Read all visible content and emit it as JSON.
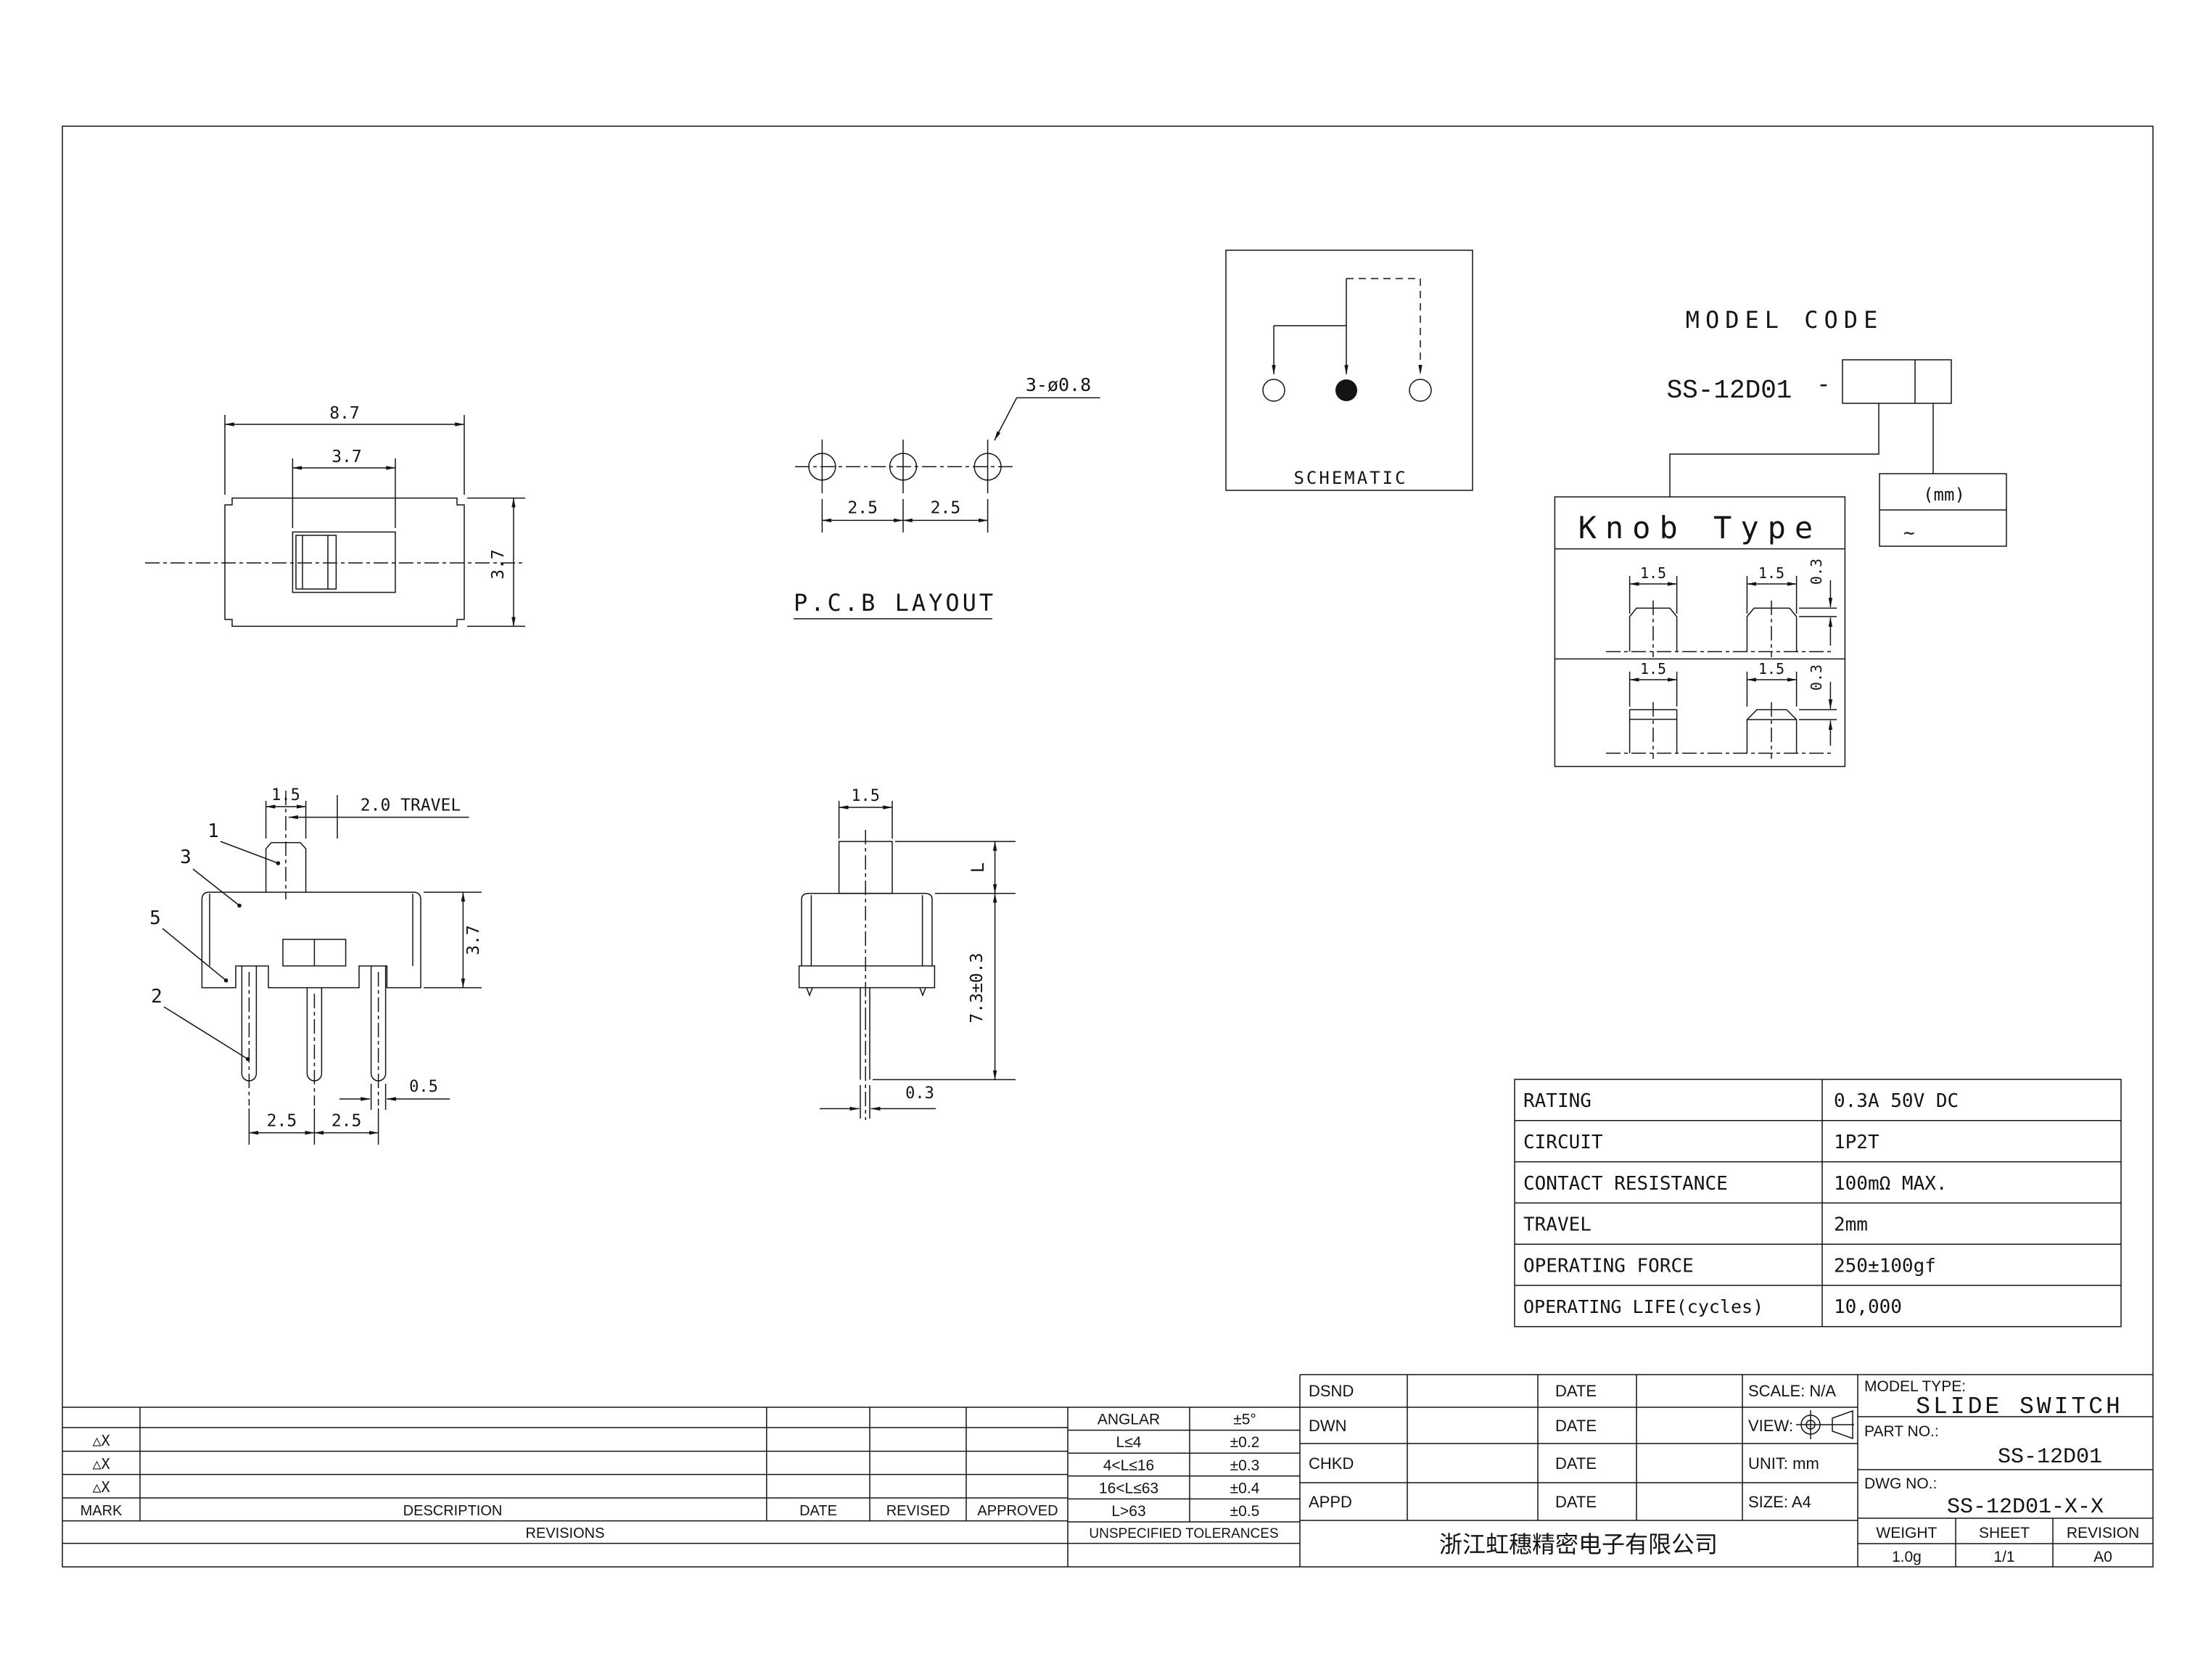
{
  "sheet": {
    "top_view": {
      "dim_width": "8.7",
      "dim_window_width": "3.7",
      "dim_height": "3.7"
    },
    "pcb_layout": {
      "title": "P.C.B LAYOUT",
      "hole_note": "3-ø0.8",
      "dim_pitch_1": "2.5",
      "dim_pitch_2": "2.5"
    },
    "schematic": {
      "label": "SCHEMATIC"
    },
    "model_code": {
      "title": "MODEL CODE",
      "code": "SS-12D01",
      "separator": "-"
    },
    "unit_box": {
      "line1": "(mm)",
      "line2": "~"
    },
    "knob_type": {
      "title": "Knob Type",
      "row1_dim_width_a": "1.5",
      "row1_dim_width_b": "1.5",
      "row1_dim_height": "0.3",
      "row2_dim_width_a": "1.5",
      "row2_dim_width_b": "1.5",
      "row2_dim_height": "0.3"
    },
    "front_view": {
      "dim_knob_width": "1.5",
      "dim_travel": "2.0 TRAVEL",
      "dim_body_height": "3.7",
      "dim_pin_width": "0.5",
      "dim_pitch_1": "2.5",
      "dim_pitch_2": "2.5",
      "callout_knob": "1",
      "callout_body": "3",
      "callout_base": "5",
      "callout_pin": "2"
    },
    "side_view": {
      "dim_knob_width": "1.5",
      "dim_knob_height": "L",
      "dim_overall_height": "7.3±0.3",
      "dim_pin_thickness": "0.3"
    }
  },
  "spec_table": {
    "rows": [
      {
        "label": "RATING",
        "value": "0.3A 50V DC"
      },
      {
        "label": "CIRCUIT",
        "value": "1P2T"
      },
      {
        "label": "CONTACT RESISTANCE",
        "value": "100mΩ MAX."
      },
      {
        "label": "TRAVEL",
        "value": "2mm"
      },
      {
        "label": "OPERATING FORCE",
        "value": "250±100gf"
      },
      {
        "label": "OPERATING LIFE(cycles)",
        "value": "10,000"
      }
    ]
  },
  "revisions_table": {
    "headers": {
      "mark": "MARK",
      "description": "DESCRIPTION",
      "date": "DATE",
      "revised": "REVISED",
      "approved": "APPROVED"
    },
    "footer": "REVISIONS",
    "row_marks": [
      "△X",
      "△X",
      "△X"
    ]
  },
  "tolerance_table": {
    "rows": [
      {
        "range": "ANGLAR",
        "tol": "±5°"
      },
      {
        "range": "L≤4",
        "tol": "±0.2"
      },
      {
        "range": "4<L≤16",
        "tol": "±0.3"
      },
      {
        "range": "16<L≤63",
        "tol": "±0.4"
      },
      {
        "range": "L>63",
        "tol": "±0.5"
      }
    ],
    "footer": "UNSPECIFIED TOLERANCES"
  },
  "title_block": {
    "rows": [
      {
        "label": "DSND",
        "date": "DATE"
      },
      {
        "label": "DWN",
        "date": "DATE"
      },
      {
        "label": "CHKD",
        "date": "DATE"
      },
      {
        "label": "APPD",
        "date": "DATE"
      }
    ],
    "scale_label": "SCALE: N/A",
    "view_label": "VIEW:",
    "unit_label": "UNIT: mm",
    "size_label": "SIZE: A4",
    "model_type_label": "MODEL TYPE:",
    "model_type": "SLIDE SWITCH",
    "part_no_label": "PART NO.:",
    "part_no": "SS-12D01",
    "dwg_no_label": "DWG NO.:",
    "dwg_no": "SS-12D01-X-X",
    "company": "浙江虹穗精密电子有限公司",
    "weight_label": "WEIGHT",
    "weight_value": "1.0g",
    "sheet_label": "SHEET",
    "sheet_value": "1/1",
    "revision_label": "REVISION",
    "revision_value": "A0"
  }
}
